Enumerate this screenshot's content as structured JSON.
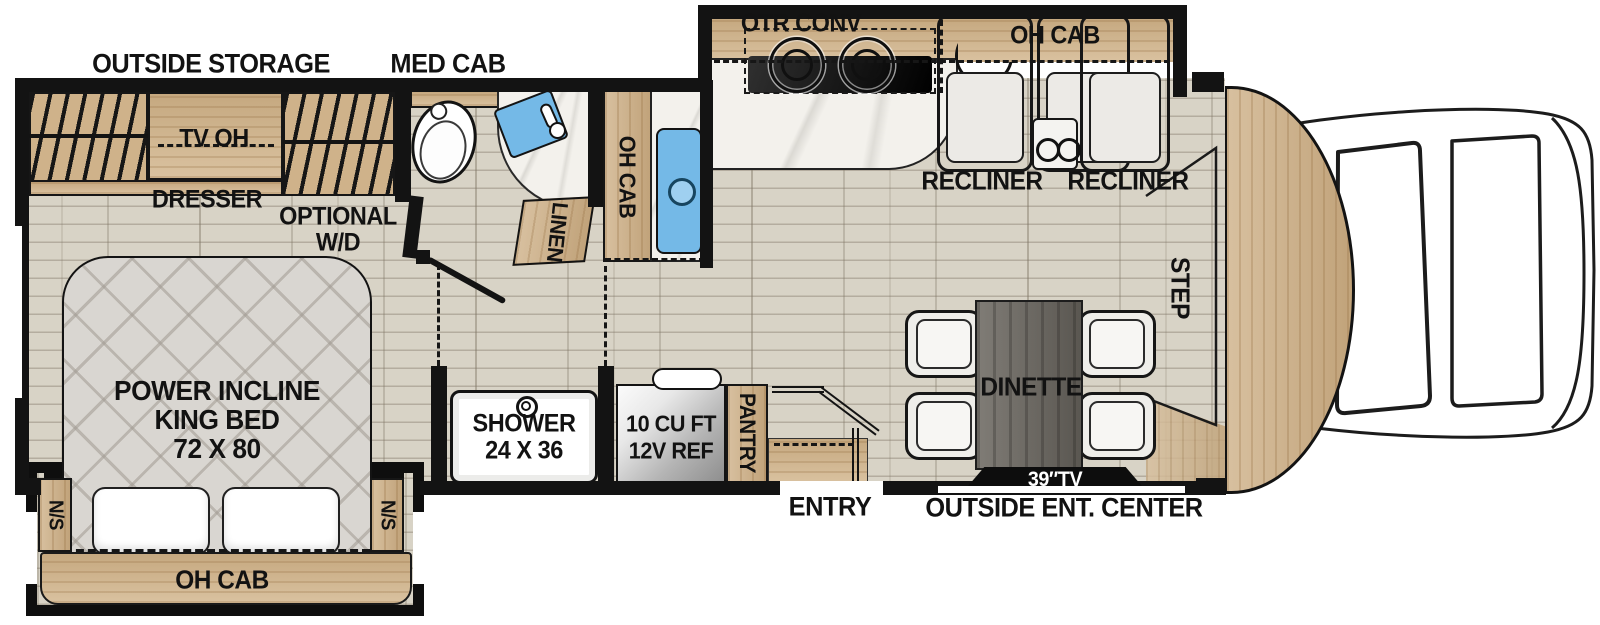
{
  "labels": {
    "outside_storage": "OUTSIDE STORAGE",
    "med_cab": "MED CAB",
    "otr_conv": "OTR CONV",
    "oh_cab_galley": "OH CAB",
    "recliner_1": "RECLINER",
    "recliner_2": "RECLINER",
    "tv_oh": "TV OH",
    "dresser": "DRESSER",
    "optional_line1": "OPTIONAL",
    "optional_line2": "W/D",
    "linen": "LINEN",
    "oh_cab_bath": "OH CAB",
    "step": "STEP",
    "bed_line1": "POWER INCLINE",
    "bed_line2": "KING BED",
    "bed_line3": "72 X 80",
    "ns_left": "N/S",
    "ns_right": "N/S",
    "oh_cab_bed": "OH CAB",
    "shower_line1": "SHOWER",
    "shower_line2": "24 X 36",
    "fridge_line1": "10 CU FT",
    "fridge_line2": "12V REF",
    "pantry": "PANTRY",
    "dinette": "DINETTE",
    "tv_39": "39″TV",
    "entry": "ENTRY",
    "outside_ent_center": "OUTSIDE ENT. CENTER"
  },
  "colors": {
    "wall": "#131313",
    "floor": "#d8d3c6",
    "cabinet_wood": "#cfb28a",
    "counter_marble": "#f3f1ec",
    "sink_blue": "#74b9e7",
    "table_wood": "#6e6a63",
    "bed_quilt": "#d9d6d1",
    "tv_text": "#ffffff"
  }
}
